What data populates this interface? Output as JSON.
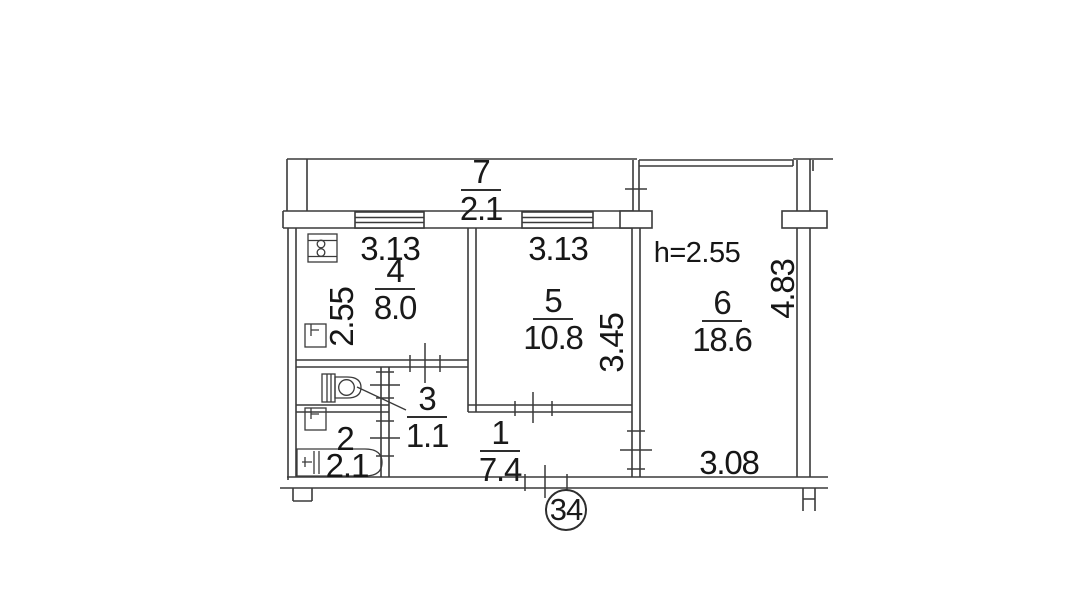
{
  "plan": {
    "apartment_number": "34",
    "ceiling_height": "h=2.55"
  },
  "rooms": [
    {
      "number": "7",
      "area": "2.1"
    },
    {
      "number": "4",
      "area": "8.0"
    },
    {
      "number": "5",
      "area": "10.8"
    },
    {
      "number": "6",
      "area": "18.6"
    },
    {
      "number": "3",
      "area": "1.1"
    },
    {
      "number": "1",
      "area": "7.4"
    },
    {
      "number": "2",
      "area": "2.1"
    }
  ],
  "dimensions": {
    "room4_width": "3.13",
    "room4_depth": "2.55",
    "room5_width": "3.13",
    "room5_depth": "3.45",
    "room6_width": "3.08",
    "room6_depth": "4.83"
  }
}
